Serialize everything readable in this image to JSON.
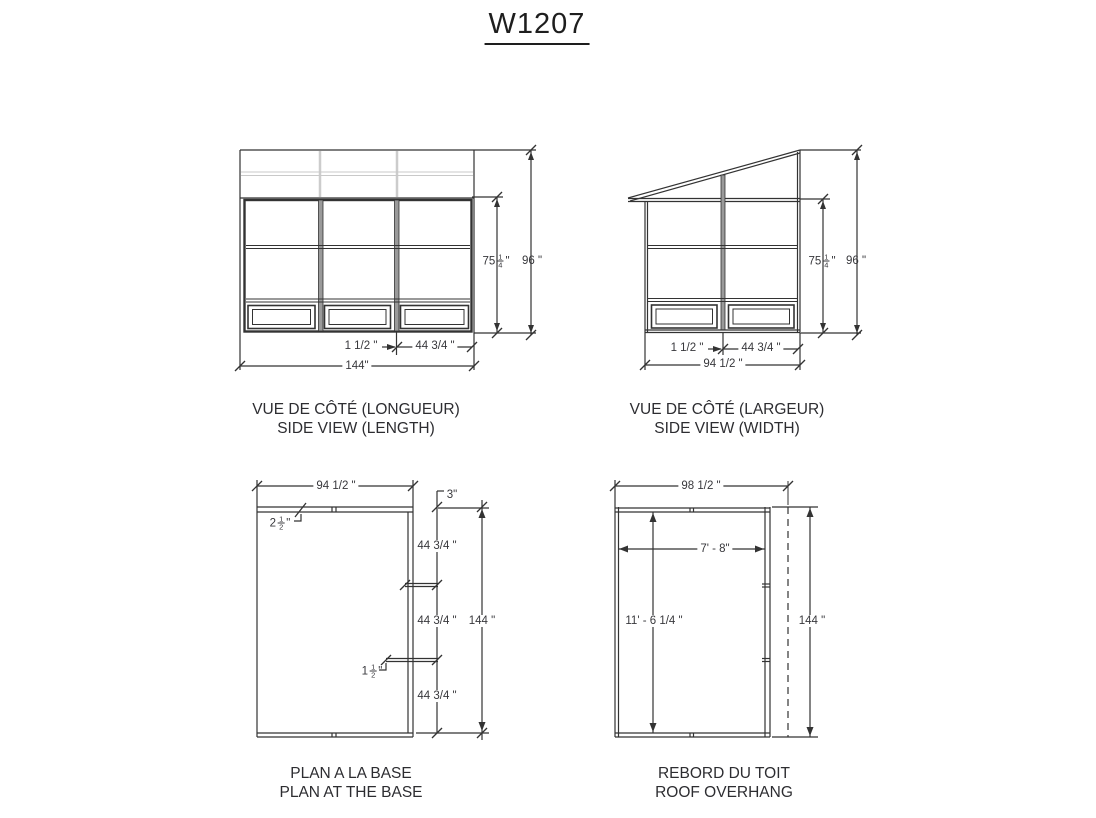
{
  "title": "W1207",
  "colors": {
    "line": "#333333",
    "light_line": "#c9c9c9",
    "text": "#38383c"
  },
  "views": {
    "side_length": {
      "caption_fr": "VUE DE CÔTÉ (LONGUEUR)",
      "caption_en": "SIDE VIEW (LENGTH)",
      "dim_inner_height": {
        "whole": "75",
        "num": "1",
        "den": "4",
        "unit": "\""
      },
      "dim_total_height": "96 \"",
      "dim_mullion": "1 1/2 \"",
      "dim_panel": "44 3/4 \"",
      "dim_total_width": "144\""
    },
    "side_width": {
      "caption_fr": "VUE DE CÔTÉ (LARGEUR)",
      "caption_en": "SIDE VIEW (WIDTH)",
      "dim_inner_height": {
        "whole": "75",
        "num": "1",
        "den": "4",
        "unit": "\""
      },
      "dim_total_height": "96 \"",
      "dim_mullion": "1 1/2 \"",
      "dim_panel": "44 3/4 \"",
      "dim_total_width": "94 1/2 \""
    },
    "plan_base": {
      "caption_fr": "PLAN A LA BASE",
      "caption_en": "PLAN AT THE BASE",
      "dim_total_width": "94 1/2 \"",
      "dim_wall_thickness": {
        "whole": "2",
        "num": "1",
        "den": "2",
        "unit": "\""
      },
      "dim_corner": "3\"",
      "dim_panel": "44 3/4 \"",
      "dim_mullion": {
        "whole": "1",
        "num": "1",
        "den": "2",
        "unit": "\""
      },
      "dim_total_depth": "144 \""
    },
    "roof_overhang": {
      "caption_fr": "REBORD DU TOIT",
      "caption_en": "ROOF OVERHANG",
      "dim_total_width": "98 1/2 \"",
      "dim_inner_width": "7' - 8\"",
      "dim_inner_depth": "11' - 6 1/4 \"",
      "dim_total_depth": "144 \""
    }
  }
}
